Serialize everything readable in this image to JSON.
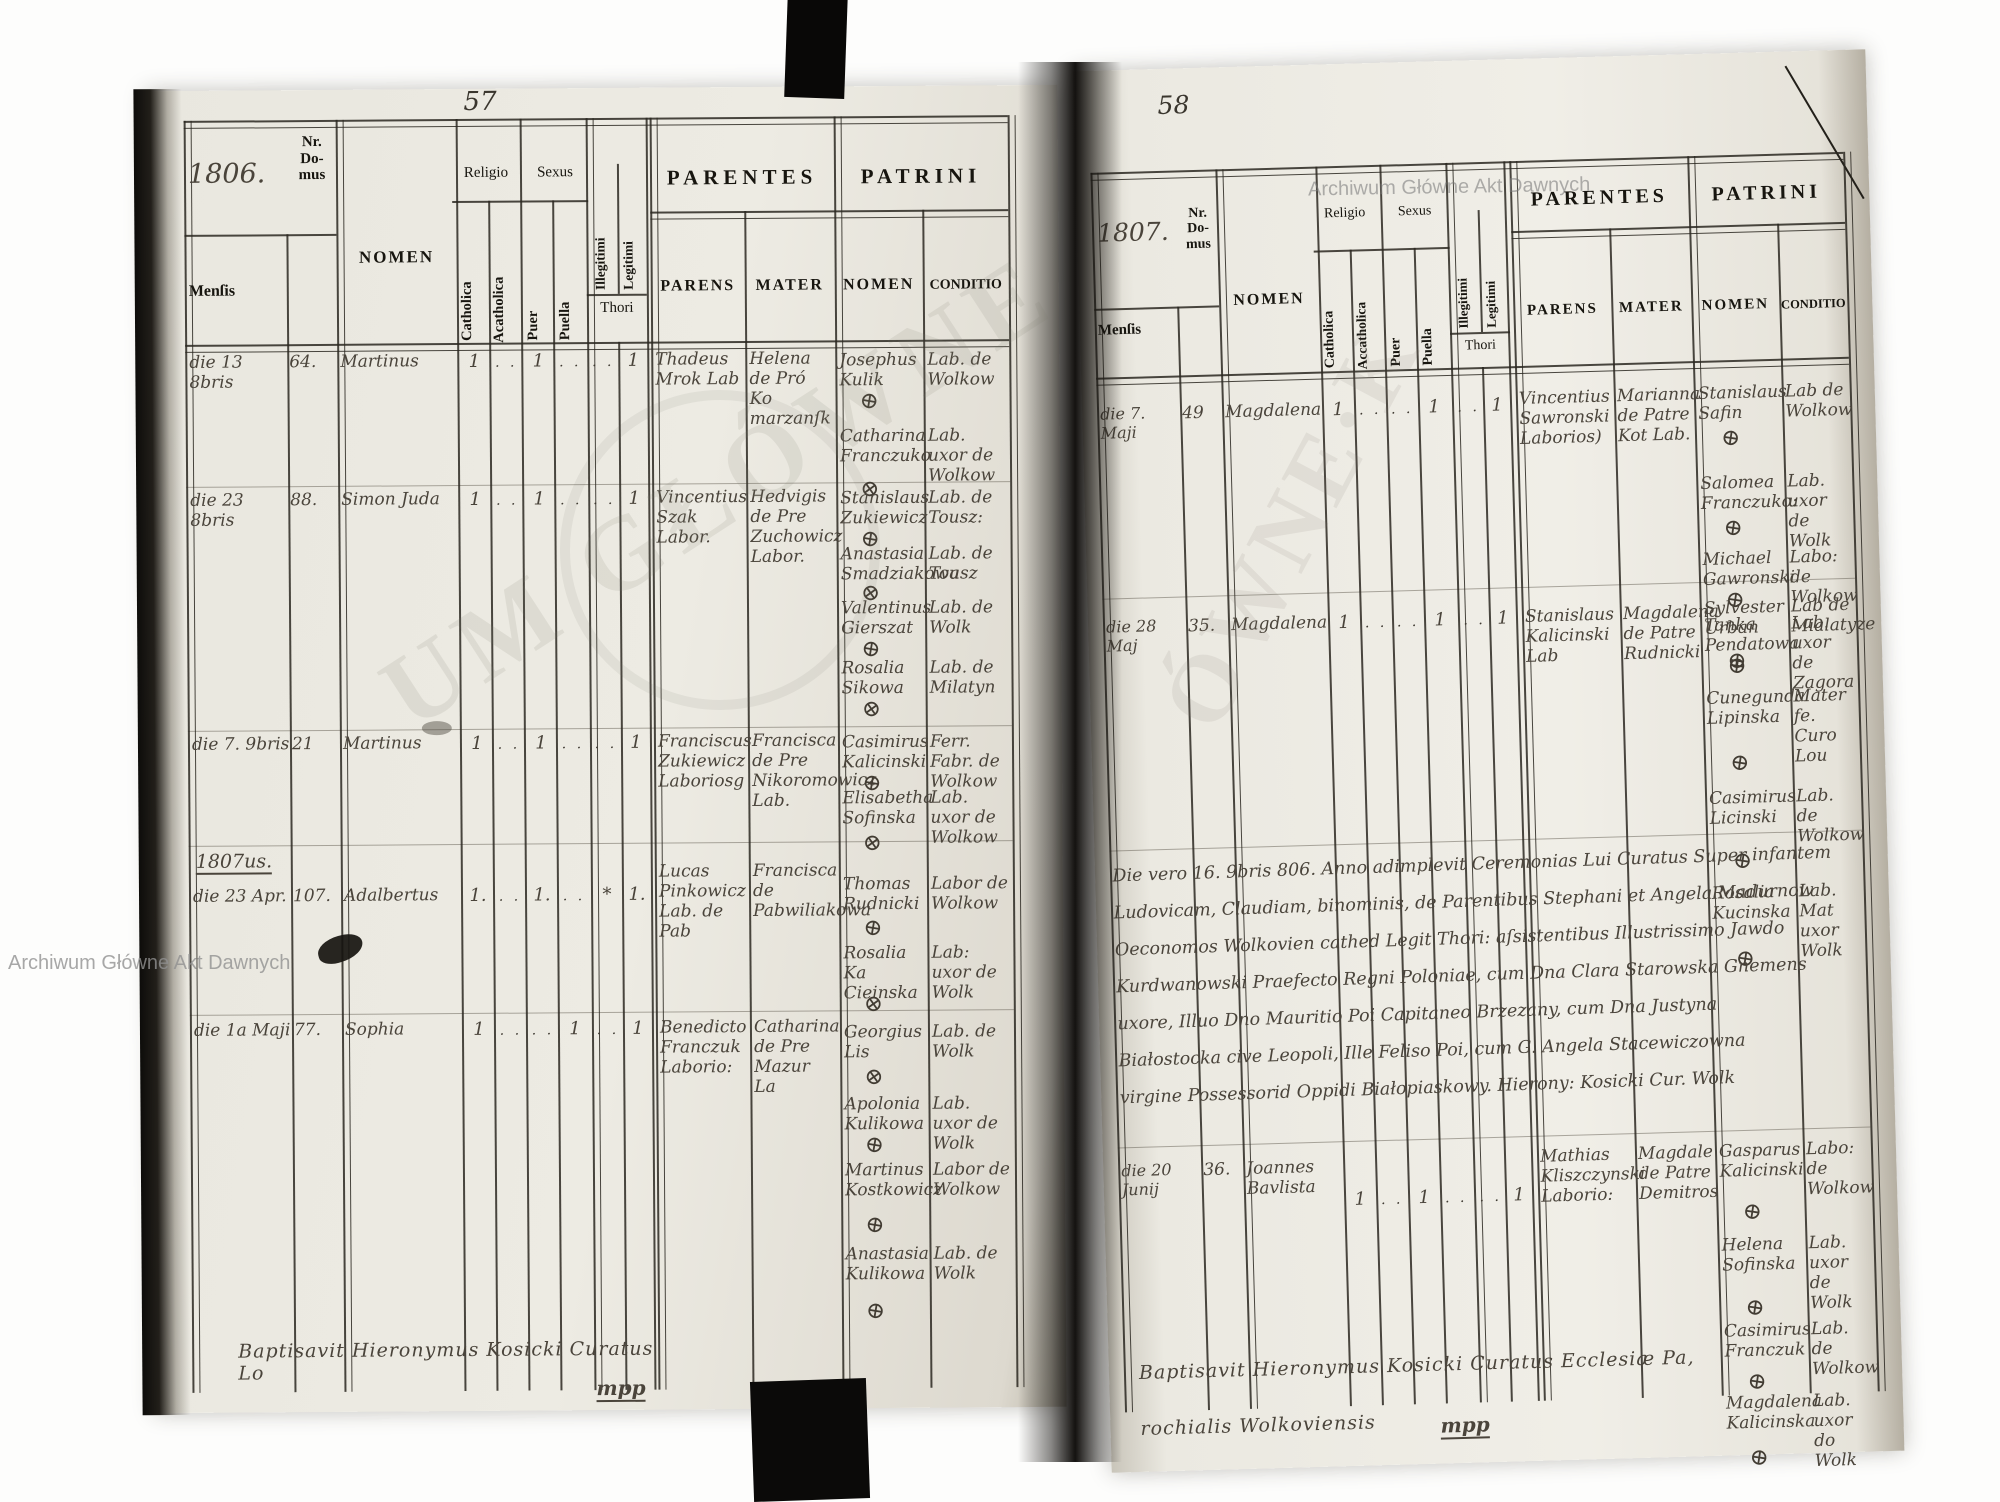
{
  "watermarks": {
    "archive_small": "Archiwum Główne Akt Dawnych",
    "archive_big_left": "UM GŁÓWNE",
    "archive_big_right": "ÓWNE·K"
  },
  "left_page": {
    "page_number": "57",
    "year": "1806.",
    "year_marker": "1807us.",
    "footer_note": "Baptisavit Hieronymus Kosicki Curatus Lo",
    "footer_sig": "mpp",
    "header": {
      "nr_domus": "Nr.\nDo-\nmus",
      "nomen": "NOMEN",
      "mensis": "Menſis",
      "religio": "Religio",
      "sexus": "Sexus",
      "catholica": "Catholica",
      "acatholica": "Acatholica",
      "puer": "Puer",
      "puella": "Puella",
      "illegitimi": "Illegitimi",
      "legitimi": "Legitimi",
      "thori": "Thori",
      "parentes": "PARENTES",
      "patrini": "PATRINI",
      "parens": "PARENS",
      "mater": "MATER",
      "patrini_nomen": "NOMEN",
      "conditio": "CONDITIO"
    },
    "rows": [
      {
        "date": "die 13 8bris",
        "nr": "64.",
        "name": "Martinus",
        "catholica": "1",
        "acatholica": ". .",
        "puer": "1",
        "puella": ". .",
        "illegitimi": ". .",
        "legitimi": "1",
        "parens": "Thadeus Mrok Lab",
        "mater": "Helena de Pró Ko marzanſk",
        "patrini": [
          {
            "name": "Josephus Kulik",
            "mark": "⊕",
            "cond": "Lab. de Wolkow"
          },
          {
            "name": "Catharina Franczuko",
            "mark": "⊗",
            "cond": "Lab. uxor de Wolkow"
          }
        ]
      },
      {
        "date": "die 23 8bris",
        "nr": "88.",
        "name": "Simon Juda",
        "catholica": "1",
        "acatholica": ". .",
        "puer": "1",
        "puella": ". .",
        "illegitimi": ". .",
        "legitimi": "1",
        "parens": "Vincentius Szak Labor.",
        "mater": "Hedvigis de Pre Zuchowicz Labor.",
        "patrini": [
          {
            "name": "Stanislaus Zukiewicz",
            "mark": "⊕",
            "cond": "Lab. de Tousz:"
          },
          {
            "name": "Anastasia Smadziakowa",
            "mark": "⊗",
            "cond": "Lab. de Tousz"
          },
          {
            "name": "Valentinus Gierszat",
            "mark": "⊕",
            "cond": "Lab. de Wolk"
          },
          {
            "name": "Rosalia Sikowa",
            "mark": "⊗",
            "cond": "Lab. de Milatyn"
          }
        ]
      },
      {
        "date": "die 7. 9bris",
        "nr": "21",
        "name": "Martinus",
        "catholica": "1",
        "acatholica": ". .",
        "puer": "1",
        "puella": ". .",
        "illegitimi": ". .",
        "legitimi": "1",
        "parens": "Franciscus Zukiewicz Laboriosg",
        "mater": "Francisca de Pre Nikoromowicz Lab.",
        "patrini": [
          {
            "name": "Casimirus Kalicinski",
            "mark": "⊕",
            "cond": "Ferr. Fabr. de Wolkow"
          },
          {
            "name": "Elisabetha Sofinska",
            "mark": "⊗",
            "cond": "Lab. uxor de Wolkow"
          }
        ]
      },
      {
        "date": "die 23 Apr.",
        "nr": "107.",
        "name": "Adalbertus",
        "catholica": "1.",
        "acatholica": ". .",
        "puer": "1.",
        "puella": ". .",
        "illegitimi": "*",
        "legitimi": "1.",
        "parens": "Lucas Pinkowicz Lab. de Pab",
        "mater": "Francisca de Pabwiliakowa",
        "patrini": [
          {
            "name": "Thomas Rudnicki",
            "mark": "⊕",
            "cond": "Labor de Wolkow"
          },
          {
            "name": "Rosalia Ka Cieinska",
            "mark": "⊗",
            "cond": "Lab: uxor de Wolk"
          }
        ]
      },
      {
        "date": "die 1a Maji",
        "nr": "77.",
        "name": "Sophia",
        "catholica": "1",
        "acatholica": ". .",
        "puer": ". .",
        "puella": "1",
        "illegitimi": ". .",
        "legitimi": "1",
        "parens": "Benedicto Franczuk Laborio:",
        "mater": "Catharina de Pre Mazur La",
        "patrini": [
          {
            "name": "Georgius Lis",
            "mark": "⊗",
            "cond": "Lab. de Wolk"
          },
          {
            "name": "Apolonia Kulikowa",
            "mark": "⊕",
            "cond": "Lab. uxor de Wolk"
          },
          {
            "name": "Martinus Kostkowicz",
            "mark": "⊕",
            "cond": "Labor de Wolkow"
          },
          {
            "name": "Anastasia Kulikowa",
            "mark": "⊕",
            "cond": "Lab. de Wolk"
          }
        ]
      }
    ]
  },
  "right_page": {
    "page_number": "58",
    "year": "1807.",
    "footer_note": "Baptisavit Hieronymus Kosicki Curatus Ecclesiæ Pa,",
    "footer_note2": "rochialis Wolkoviensis",
    "footer_sig": "mpp",
    "header": {
      "nr_domus": "Nr.\nDo-\nmus",
      "nomen": "NOMEN",
      "mensis": "Menſis",
      "religio": "Religio",
      "sexus": "Sexus",
      "catholica": "Catholica",
      "acatholica": "Accatholica",
      "puer": "Puer",
      "puella": "Puella",
      "illegitimi": "Illegitimi",
      "legitimi": "Legitimi",
      "thori": "Thori",
      "parentes": "PARENTES",
      "patrini": "PATRINI",
      "parens": "PARENS",
      "mater": "MATER",
      "patrini_nomen": "NOMEN",
      "conditio": "CONDITIO"
    },
    "annotation_lines": [
      "Die vero 16. 9bris 806. Anno adimplevit Ceremonias Lui Curatus    Super infantem",
      "Ludovicam, Claudiam, binominis, de Parentibus Stephani et Angela Madurnow",
      "Oeconomos Wolkovien cathed Legit Thori: aſsistentibus Illustrissimo Jawdo",
      "Kurdwanowski Praefecto Regni Poloniae, cum Dna Clara Starowska Gnemens",
      "uxore, Illuo Dno Mauritio Poi Capitaneo Brzezany, cum Dna Justyna",
      "Białostocka cive Leopoli, Ille Feliso Poi, cum G. Angela Stacewiczowna",
      "virgine Possessorid Oppidi Białopiaskowy.   Hierony: Kosicki Cur. Wolk"
    ],
    "rows": [
      {
        "date": "die 7. Maji",
        "nr": "49",
        "name": "Magdalena",
        "catholica": "1",
        "acatholica": ". .",
        "puer": ". .",
        "puella": "1",
        "illegitimi": ". .",
        "legitimi": "1",
        "parens": "Vincentius Sawronski Laborios)",
        "mater": "Marianna de Patre Kot Lab.",
        "patrini": [
          {
            "name": "Stanislaus Safin",
            "mark": "⊕",
            "cond": "Lab de Wolkow"
          },
          {
            "name": "Salomea Franczuko:",
            "mark": "⊕",
            "cond": "Lab. uxor de Wolk"
          },
          {
            "name": "Michael Gawronski",
            "mark": "⊕",
            "cond": "Labo: de Wolkow"
          },
          {
            "name": "Tanka Pendatowa",
            "mark": "⊕",
            "cond": "Lab. uxor de Zagora"
          }
        ]
      },
      {
        "date": "die 28 Maj",
        "nr": "35.",
        "name": "Magdalena",
        "catholica": "1",
        "acatholica": ". .",
        "puer": ". .",
        "puella": "1",
        "illegitimi": ". .",
        "legitimi": "1",
        "parens": "Stanislaus Kalicinski Lab",
        "mater": "Magdalena de Patre Rudnicki",
        "patrini": [
          {
            "name": "Sylvester Urban",
            "mark": "⊕",
            "cond": "Lab de Mialatyze"
          },
          {
            "name": "Cunegunda Lipinska",
            "mark": "⊕",
            "cond": "Mater fe. Curo Lou"
          },
          {
            "name": "Casimirus Licinski",
            "mark": "⊕",
            "cond": "Lab. de Wolkow"
          },
          {
            "name": "Rosalia Kucinska",
            "mark": "⊕",
            "cond": "Lab. Mat uxor Wolk"
          }
        ]
      },
      {
        "date": "die 20 Junij",
        "nr": "36.",
        "name": "Joannes Bavlista",
        "catholica": "1",
        "acatholica": ". .",
        "puer": "1",
        "puella": ". .",
        "illegitimi": ". .",
        "legitimi": "1",
        "parens": "Mathias Kliszczynski Laborio:",
        "mater": "Magdale de Patre Demitros",
        "patrini": [
          {
            "name": "Gasparus Kalicinski",
            "mark": "⊕",
            "cond": "Labo: de Wolkow"
          },
          {
            "name": "Helena Sofinska",
            "mark": "⊕",
            "cond": "Lab. uxor de Wolk"
          },
          {
            "name": "Casimirus Franczuk",
            "mark": "⊕",
            "cond": "Lab. de Wolkow"
          },
          {
            "name": "Magdalena Kalicinska",
            "mark": "⊕",
            "cond": "Lab. uxor do Wolk"
          }
        ]
      }
    ]
  }
}
